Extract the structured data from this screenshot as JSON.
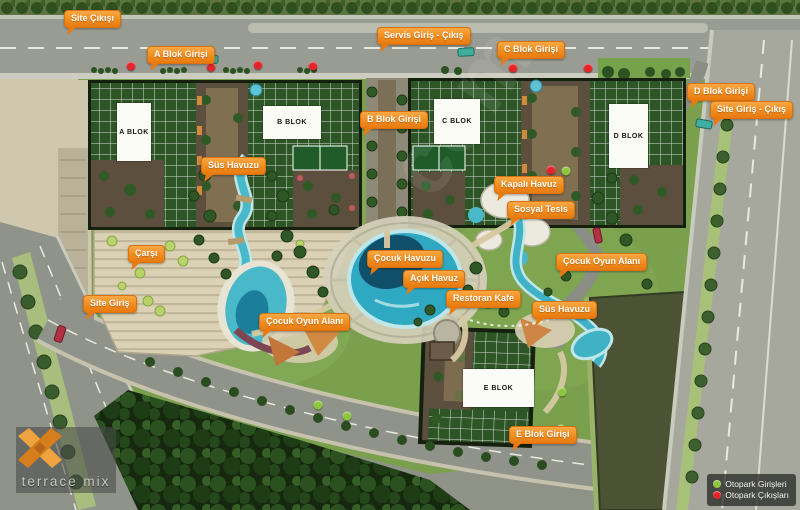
{
  "brand": {
    "name": "terrace mix"
  },
  "watermark": "com",
  "callouts": [
    {
      "text": "Site Çıkışı",
      "x": 64,
      "y": 10
    },
    {
      "text": "A Blok Girişi",
      "x": 147,
      "y": 46
    },
    {
      "text": "Servis Giriş - Çıkış",
      "x": 377,
      "y": 27
    },
    {
      "text": "C Blok Girişi",
      "x": 497,
      "y": 41
    },
    {
      "text": "D Blok Girişi",
      "x": 687,
      "y": 83
    },
    {
      "text": "Site Giriş - Çıkış",
      "x": 710,
      "y": 101
    },
    {
      "text": "B Blok Girişi",
      "x": 360,
      "y": 111
    },
    {
      "text": "Süs Havuzu",
      "x": 201,
      "y": 157
    },
    {
      "text": "Kapalı Havuz",
      "x": 494,
      "y": 176
    },
    {
      "text": "Sosyal Tesis",
      "x": 507,
      "y": 201
    },
    {
      "text": "Çarşı",
      "x": 128,
      "y": 245
    },
    {
      "text": "Çocuk Havuzu",
      "x": 367,
      "y": 250
    },
    {
      "text": "Açık Havuz",
      "x": 403,
      "y": 270
    },
    {
      "text": "Çocuk Oyun Alanı",
      "x": 556,
      "y": 253
    },
    {
      "text": "Restoran Kafe",
      "x": 446,
      "y": 290
    },
    {
      "text": "Süs Havuzu",
      "x": 532,
      "y": 301
    },
    {
      "text": "Site Giriş",
      "x": 83,
      "y": 295
    },
    {
      "text": "Çocuk Oyun Alanı",
      "x": 259,
      "y": 313
    },
    {
      "text": "E Blok Girişi",
      "x": 509,
      "y": 426
    }
  ],
  "blocks": [
    {
      "name": "A BLOK",
      "x": 117,
      "y": 103,
      "w": 34,
      "h": 58
    },
    {
      "name": "B BLOK",
      "x": 263,
      "y": 106,
      "w": 58,
      "h": 33
    },
    {
      "name": "C BLOK",
      "x": 434,
      "y": 99,
      "w": 46,
      "h": 45
    },
    {
      "name": "D BLOK",
      "x": 609,
      "y": 104,
      "w": 39,
      "h": 64
    },
    {
      "name": "E BLOK",
      "x": 463,
      "y": 369,
      "w": 71,
      "h": 38
    }
  ],
  "legend": {
    "items": [
      {
        "label": "Otopark Girişleri",
        "color": "#8ec63f"
      },
      {
        "label": "Otopark Çıkışları",
        "color": "#e3242b"
      }
    ]
  },
  "markers": {
    "entrances": {
      "color": "#8ec63f",
      "points": [
        {
          "x": 566,
          "y": 171
        },
        {
          "x": 318,
          "y": 405
        },
        {
          "x": 347,
          "y": 416
        },
        {
          "x": 562,
          "y": 392
        },
        {
          "x": 561,
          "y": 429
        }
      ]
    },
    "exits": {
      "color": "#e3242b",
      "points": [
        {
          "x": 131,
          "y": 66
        },
        {
          "x": 211,
          "y": 67
        },
        {
          "x": 258,
          "y": 65
        },
        {
          "x": 313,
          "y": 66
        },
        {
          "x": 513,
          "y": 68
        },
        {
          "x": 588,
          "y": 68
        },
        {
          "x": 551,
          "y": 170
        }
      ]
    }
  }
}
